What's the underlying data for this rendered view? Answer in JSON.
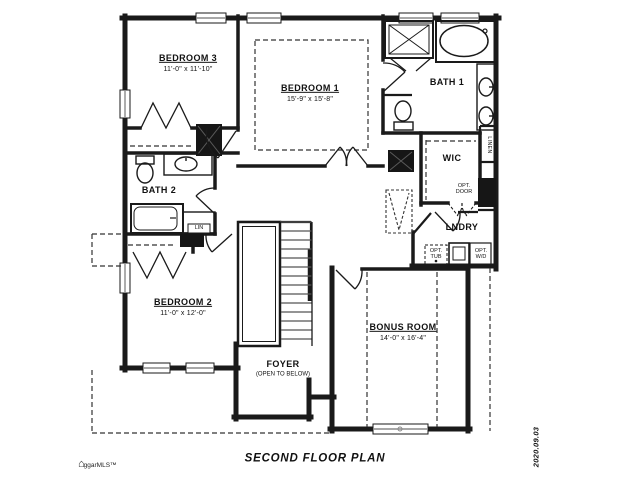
{
  "title": "SECOND FLOOR PLAN",
  "date_stamp": "2020.09.03",
  "watermark": "ggarMLS™",
  "rooms": {
    "bedroom1": {
      "name": "BEDROOM 1",
      "dims": "15'-9\" x 15'-8\""
    },
    "bedroom2": {
      "name": "BEDROOM 2",
      "dims": "11'-0\" x 12'-0\""
    },
    "bedroom3": {
      "name": "BEDROOM 3",
      "dims": "11'-0\" x 11'-10\""
    },
    "bath1": {
      "name": "BATH 1"
    },
    "bath2": {
      "name": "BATH 2"
    },
    "wic": {
      "name": "WIC"
    },
    "lndry": {
      "name": "LNDRY"
    },
    "foyer": {
      "name": "FOYER",
      "note": "(OPEN TO BELOW)"
    },
    "bonus": {
      "name": "BONUS ROOM",
      "dims": "14'-0\" x 16'-4\""
    }
  },
  "closets": {
    "lin": "LIN",
    "linen": "LINEN"
  },
  "options": {
    "opt_door": "OPT.\nDOOR",
    "opt_tub": "OPT.\nTUB",
    "opt_wd": "OPT.\nW/D"
  }
}
